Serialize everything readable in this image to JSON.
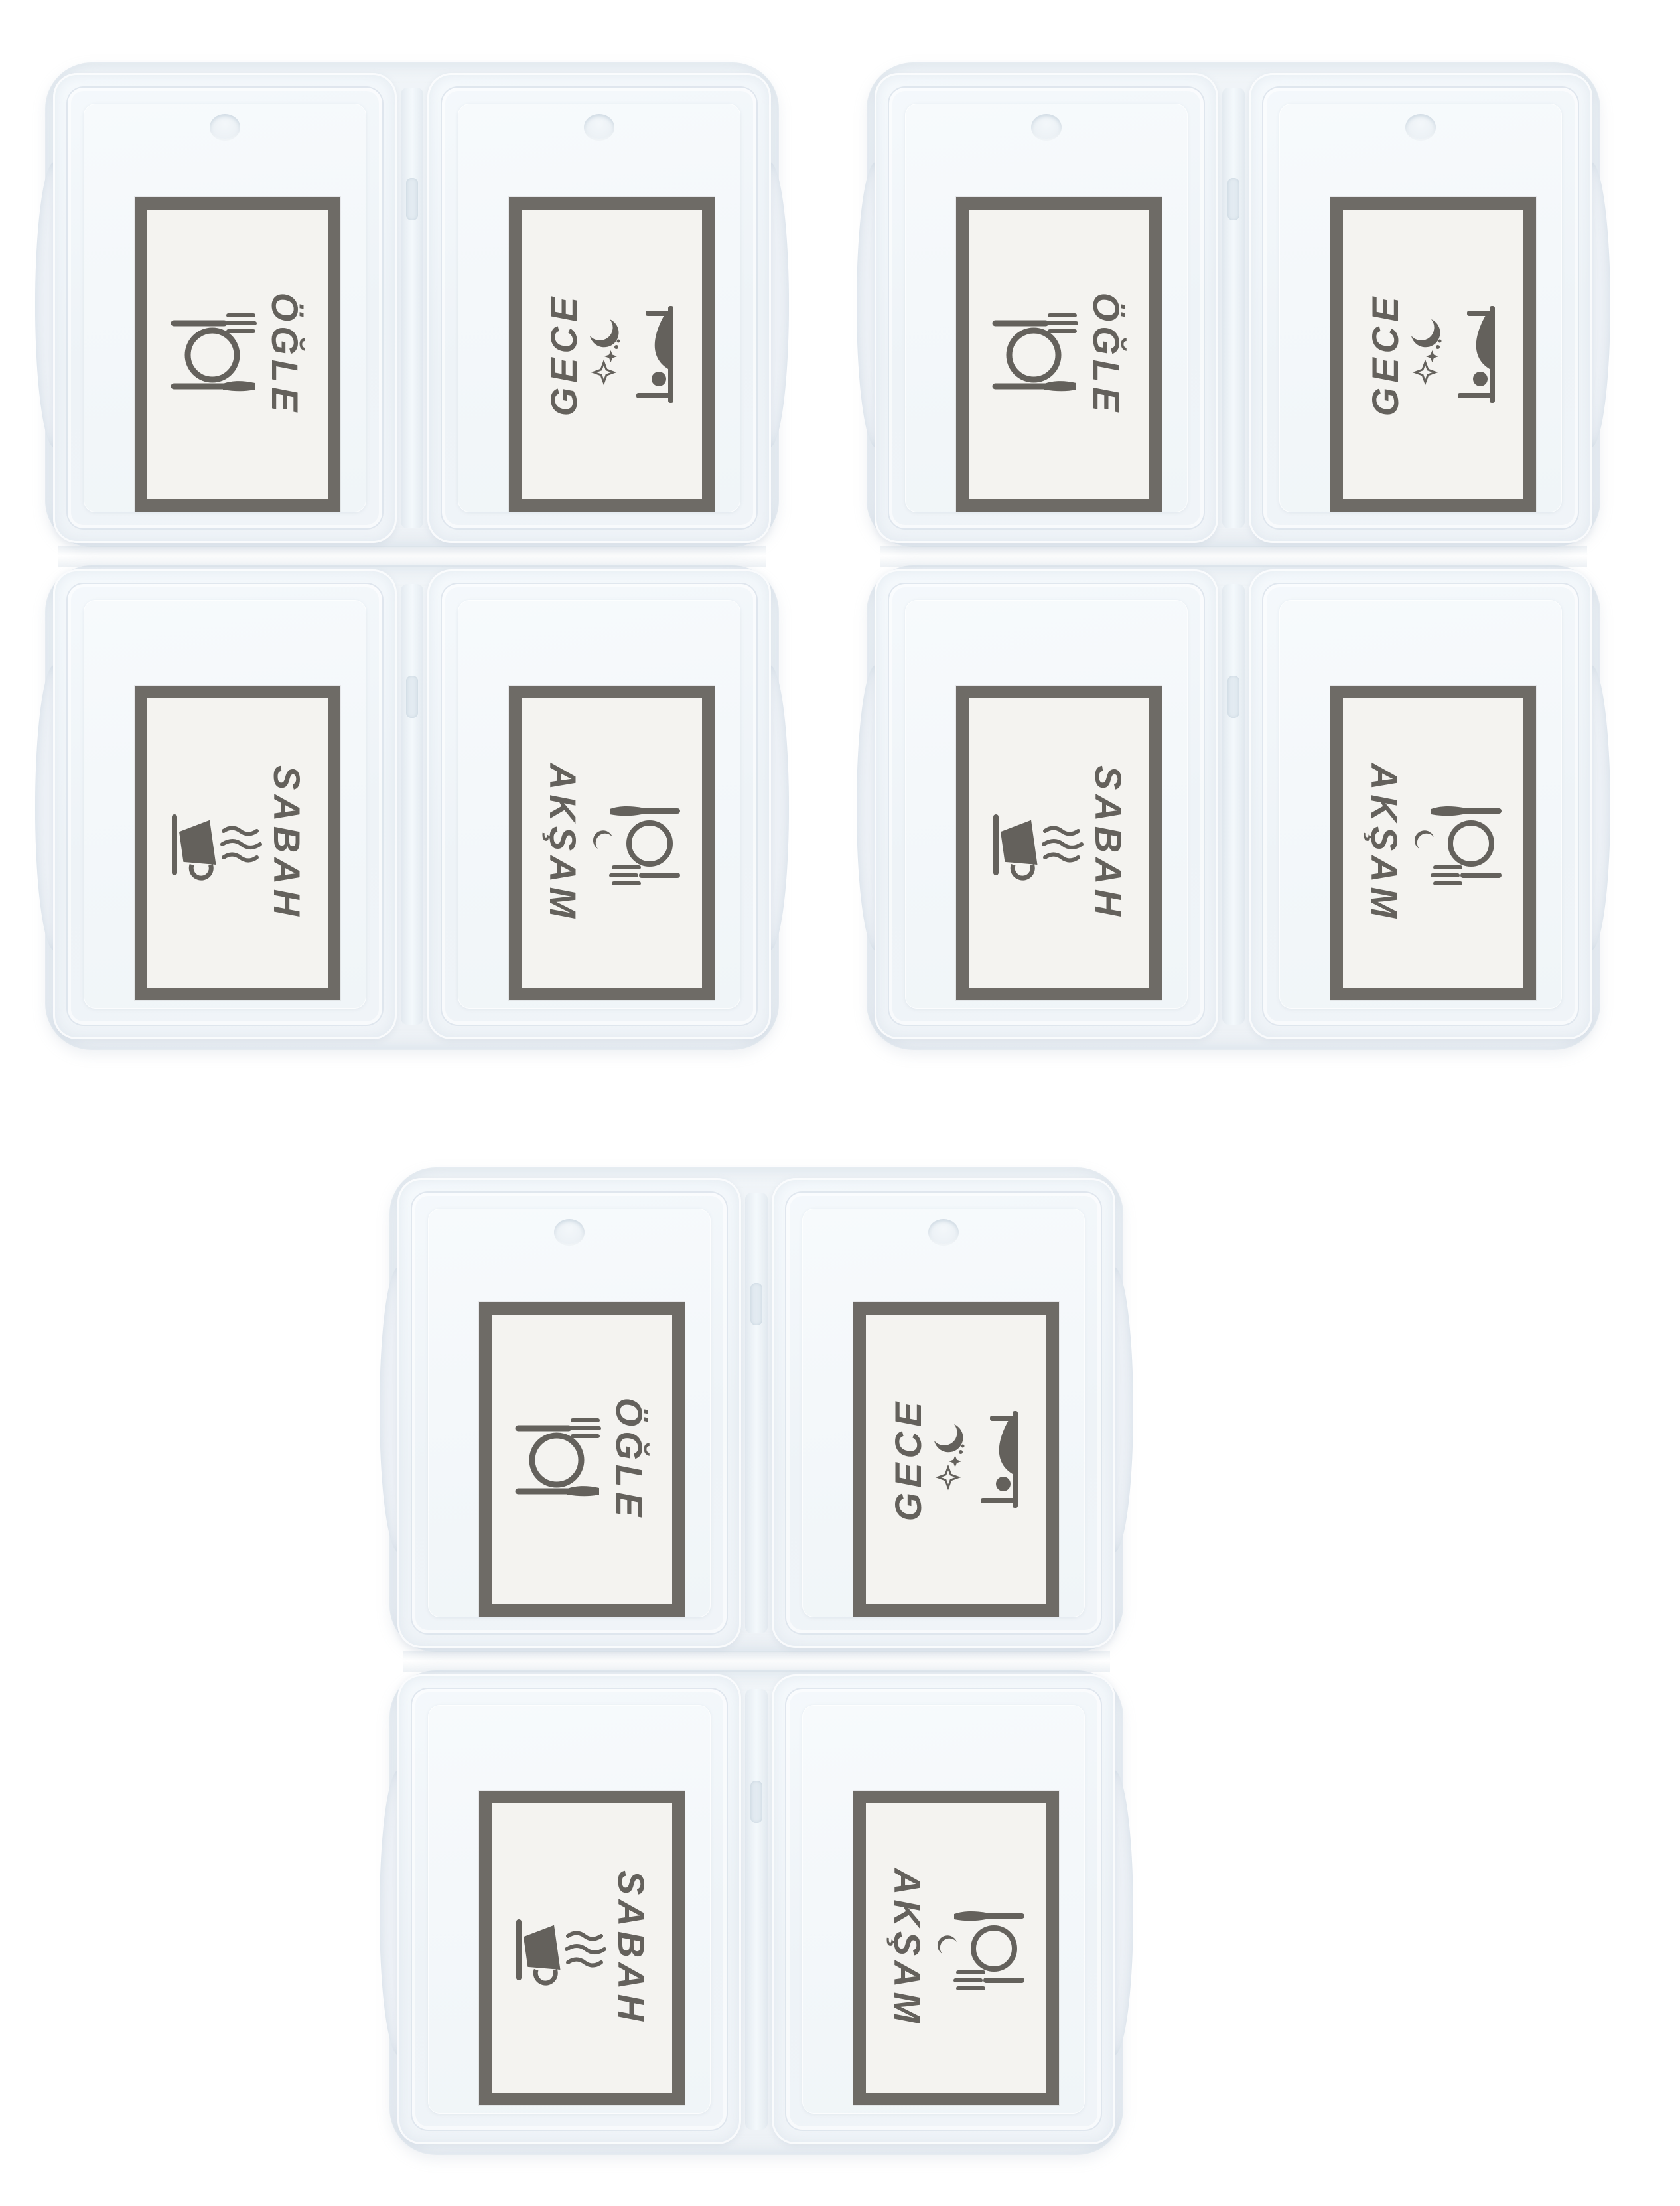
{
  "photo": {
    "background_color": "#ffffff",
    "box_count": 3,
    "plastic_color": "#eef2f6",
    "print_color": "#55524c",
    "label_background": "#f4f3f0"
  },
  "boxes": [
    {
      "position": "top-left",
      "compartments": [
        {
          "position": "top-left",
          "label": "ÖĞLE",
          "icon": "plate-cutlery-icon",
          "text_rotation": "clockwise"
        },
        {
          "position": "top-right",
          "label": "GECE",
          "icon": "moon-stars-bed-icon",
          "text_rotation": "counter-clockwise"
        },
        {
          "position": "bottom-left",
          "label": "SABAH",
          "icon": "steaming-cup-icon",
          "text_rotation": "clockwise"
        },
        {
          "position": "bottom-right",
          "label": "AKŞAM",
          "icon": "crescent-plate-cutlery-icon",
          "text_rotation": "clockwise"
        }
      ]
    },
    {
      "position": "top-right",
      "compartments": [
        {
          "position": "top-left",
          "label": "ÖĞLE",
          "icon": "plate-cutlery-icon",
          "text_rotation": "clockwise"
        },
        {
          "position": "top-right",
          "label": "GECE",
          "icon": "moon-stars-bed-icon",
          "text_rotation": "counter-clockwise"
        },
        {
          "position": "bottom-left",
          "label": "SABAH",
          "icon": "steaming-cup-icon",
          "text_rotation": "clockwise"
        },
        {
          "position": "bottom-right",
          "label": "AKŞAM",
          "icon": "crescent-plate-cutlery-icon",
          "text_rotation": "clockwise"
        }
      ]
    },
    {
      "position": "bottom-center",
      "compartments": [
        {
          "position": "top-left",
          "label": "ÖĞLE",
          "icon": "plate-cutlery-icon",
          "text_rotation": "clockwise"
        },
        {
          "position": "top-right",
          "label": "GECE",
          "icon": "moon-stars-bed-icon",
          "text_rotation": "counter-clockwise"
        },
        {
          "position": "bottom-left",
          "label": "SABAH",
          "icon": "steaming-cup-icon",
          "text_rotation": "clockwise"
        },
        {
          "position": "bottom-right",
          "label": "AKŞAM",
          "icon": "crescent-plate-cutlery-icon",
          "text_rotation": "clockwise"
        }
      ]
    }
  ]
}
